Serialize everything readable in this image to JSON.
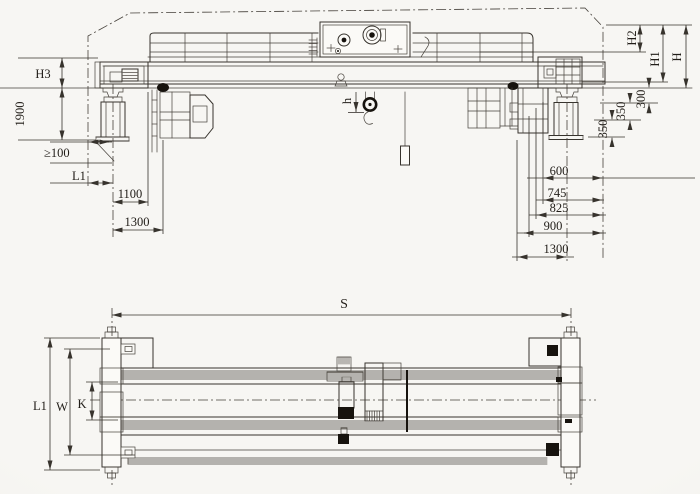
{
  "colors": {
    "line": "#37332d",
    "paper": "#f5f3ef",
    "ink_black": "#17130e"
  },
  "front_view": {
    "labels": {
      "h3": "H3",
      "d1900": "1900",
      "clearance": "≥100",
      "l1": "L1",
      "d1100": "1100",
      "d1300_left": "1300",
      "hook_height": "h",
      "h2": "H2",
      "h1": "H1",
      "h_total": "H",
      "d300": "300",
      "d350_upper": "350",
      "d350_lower": "350",
      "d600": "600",
      "d745": "745",
      "d825": "825",
      "d900": "900",
      "d1300_right": "1300"
    }
  },
  "plan_view": {
    "labels": {
      "span": "S",
      "l1": "L1",
      "wheelbase": "W",
      "gauge": "K"
    }
  }
}
